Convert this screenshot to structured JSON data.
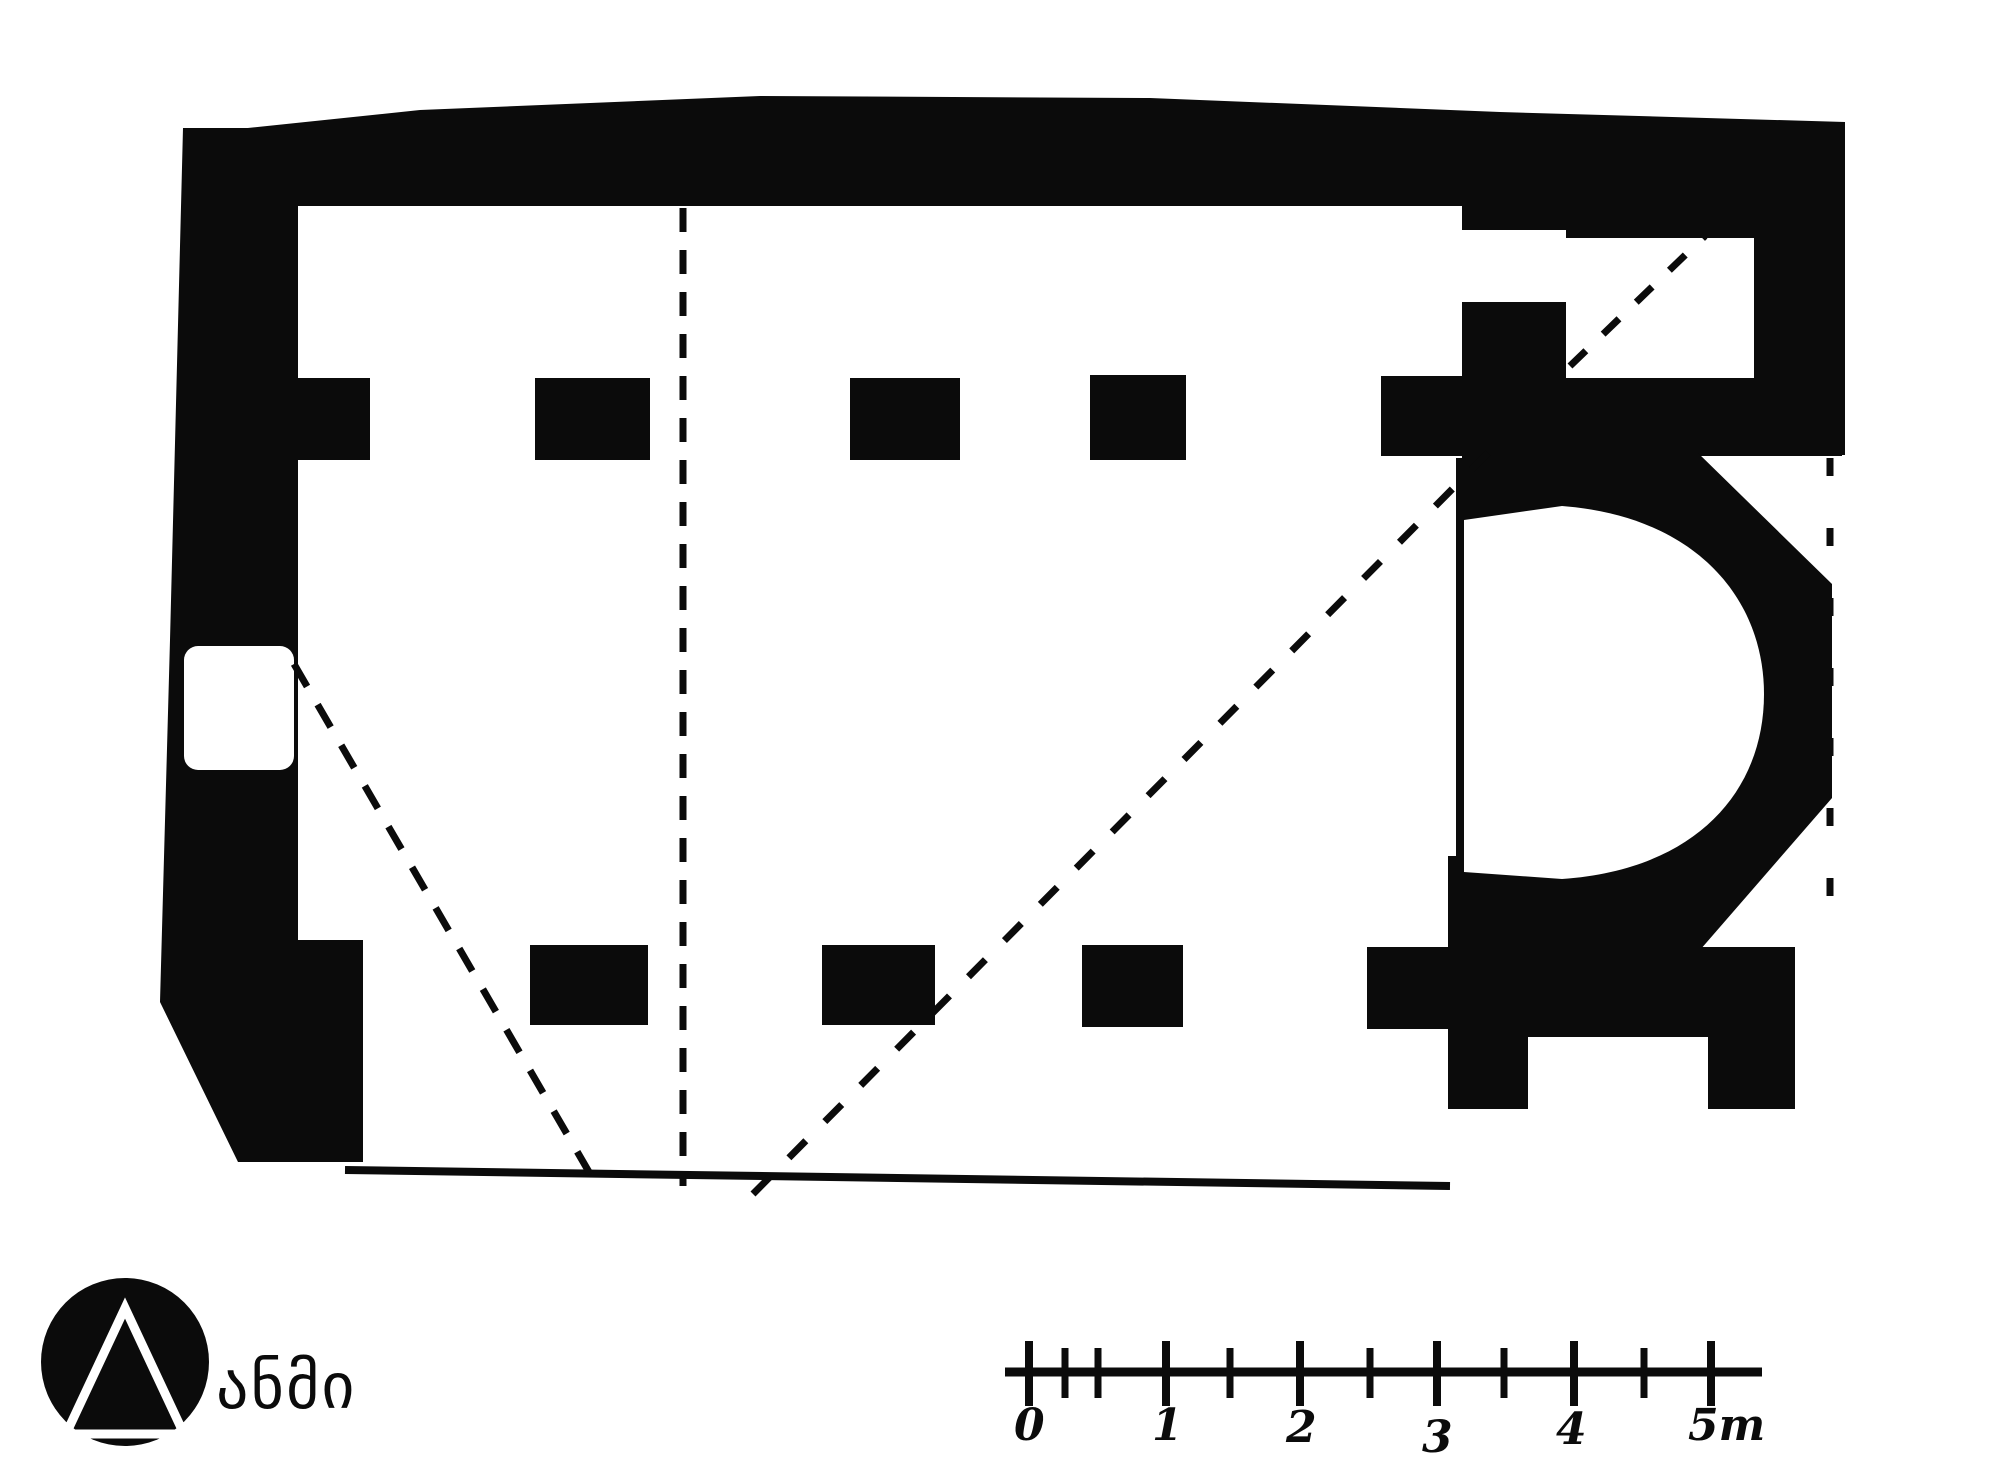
{
  "document": {
    "type": "architectural-floor-plan",
    "subject": "single-nave church plan with horseshoe apse, hand-drawn black ink survey drawing",
    "orientation": "apse on the right (east), entrance door in left (west) wall",
    "colors": {
      "ink": "#0b0b0b",
      "paper": "#ffffff"
    }
  },
  "plan": {
    "features": [
      "north-wall",
      "west-wall-with-door",
      "beveled-southwest-corner",
      "north-pier-row",
      "south-wall-segments",
      "chancel-piers",
      "horseshoe-apse",
      "northeast-chamber",
      "dashed-reconstruction-lines",
      "ruined-south-wall-outline",
      "ruined-east-wall-dashed-line"
    ]
  },
  "scale_bar": {
    "unit": "m",
    "labels": [
      "0",
      "1",
      "2",
      "3",
      "4",
      "5m"
    ],
    "major_ticks_m": [
      0,
      1,
      2,
      3,
      4,
      5
    ],
    "minor_ticks_m": [
      0.25,
      0.5,
      1.5,
      2.5,
      3.5,
      4.5
    ]
  },
  "logo": {
    "mark": "black circle with white outlined triangle",
    "text": "ანმი"
  }
}
